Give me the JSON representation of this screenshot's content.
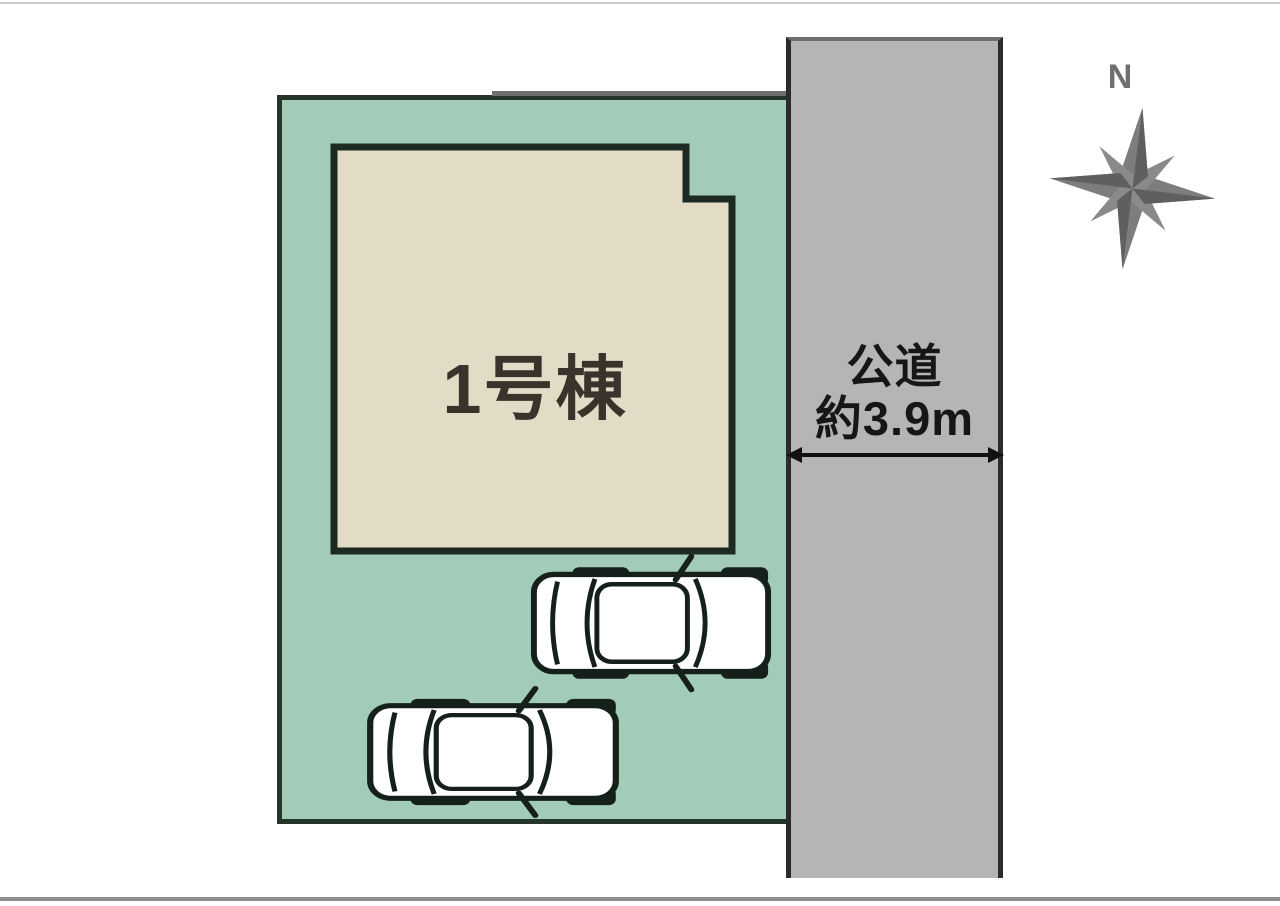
{
  "diagram": {
    "building": {
      "label": "1号棟",
      "fill": "#e2dcc7",
      "outline": "#1c2a21"
    },
    "lot": {
      "fill": "#a3ccb8",
      "outline": "#24352c"
    },
    "road": {
      "label_line1": "公道",
      "label_line2": "約3.9m",
      "fill": "#b5b5b5",
      "edge": "#2b2b2b"
    },
    "compass": {
      "north_label": "N",
      "color": "#7d7d7d"
    },
    "cars": {
      "fill": "#ffffff",
      "outline": "#15201a"
    }
  }
}
